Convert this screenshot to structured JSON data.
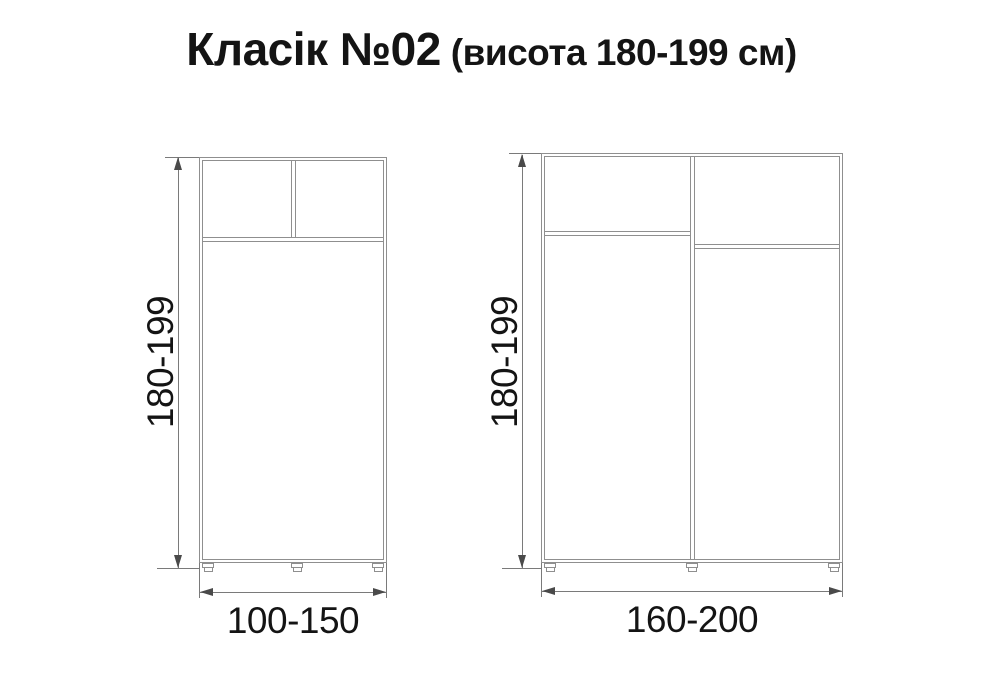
{
  "title": {
    "main": "Класік №02",
    "suffix": "(висота 180-199 см)"
  },
  "figures": {
    "left": {
      "height_label": "180-199",
      "width_label": "100-150"
    },
    "right": {
      "height_label": "180-199",
      "width_label": "160-200"
    }
  },
  "colors": {
    "background": "#ffffff",
    "line": "#8f8f8f",
    "dimline": "#7a7a7a",
    "arrow": "#4a4a4a",
    "text": "#141414"
  }
}
